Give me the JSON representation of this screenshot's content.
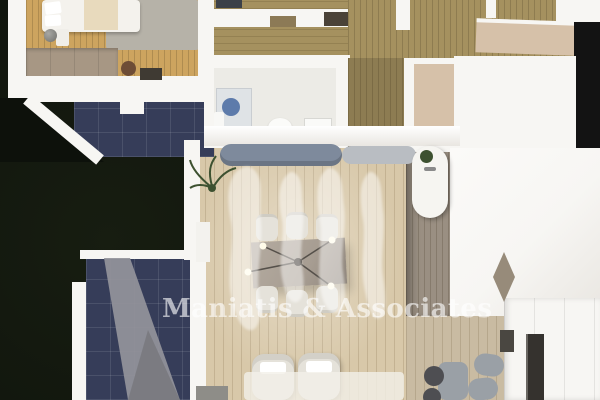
{
  "scene": {
    "kind": "top-down 3D architectural floor plan rendering",
    "watermark_figure_count": 4
  },
  "watermark": {
    "text": "Maniatis & Associates"
  },
  "colors": {
    "lawn": "#0d110b",
    "lawn_light": "#171d11",
    "wall_white": "#f7f6f3",
    "wall_shade": "#e9e6e1",
    "wood_bedroom": "#cda45f",
    "rug_gray": "#b6b2a8",
    "bed_white": "#f4f2ed",
    "blanket_cream": "#e8dabd",
    "dresser_wood": "#a79784",
    "pouf_brown": "#6e4d36",
    "tile_navy": "#363d59",
    "ramp_gray": "#94949b",
    "wood_olive": "#a5915f",
    "wood_hall": "#8d7c52",
    "bath_floor": "#ecebe6",
    "shower_blue": "#5d7bab",
    "wood_dining": "#d8c8a9",
    "kitchen_floor": "#9a8f82",
    "beige_floor": "#c9bba2",
    "counter_tan": "#d6c1a9",
    "sofa_blue": "#7e8a9c",
    "sofa_light": "#b9bdc2",
    "table_gray": "#a79d92",
    "chair_white": "#e5e2da",
    "stool_gray": "#9aa0a6",
    "stool_dark": "#4e4e52",
    "appliance_dark": "#35322e",
    "black_edge": "#131313",
    "plant_green": "#3d5130",
    "door_dark": "#4a4238",
    "watermark_white": "rgba(255,255,255,0.62)",
    "watermark_figure": "rgba(255,255,255,0.48)"
  }
}
